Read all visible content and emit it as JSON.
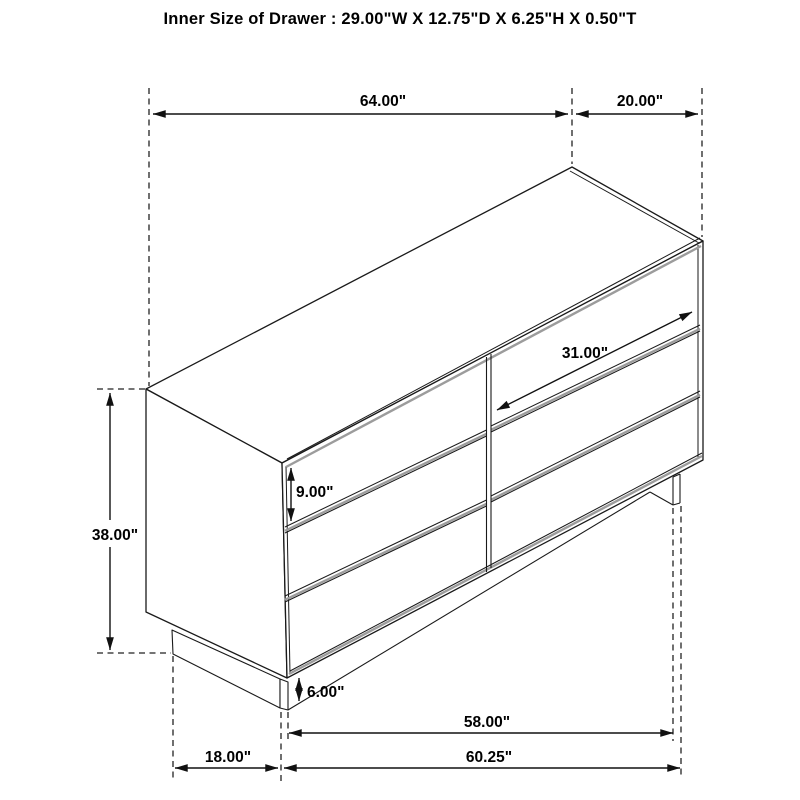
{
  "title": "Inner Size of Drawer : 29.00\"W X 12.75\"D X 6.25\"H X 0.50\"T",
  "labels": {
    "top_width": "64.00\"",
    "top_depth": "20.00\"",
    "overall_height": "38.00\"",
    "drawer_front_height": "9.00\"",
    "drawer_inner_width": "31.00\"",
    "base_height": "6.00\"",
    "base_front_width": "58.00\"",
    "bottom_full_width": "60.25\"",
    "base_side_depth": "18.00\""
  },
  "colors": {
    "line": "#1a1a1a",
    "shade_gray": "#9c9c9c",
    "text": "#000000",
    "background": "#ffffff"
  }
}
